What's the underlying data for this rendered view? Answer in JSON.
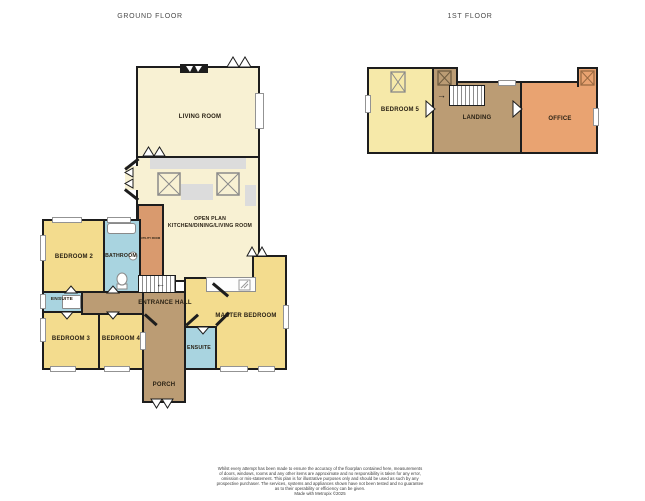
{
  "titles": {
    "ground": "GROUND FLOOR",
    "first": "1ST FLOOR"
  },
  "rooms": {
    "living_room": "LIVING ROOM",
    "open_plan_1": "OPEN PLAN",
    "open_plan_2": "KITCHEN/DINING/LIVING ROOM",
    "utility": "UTILITY ROOM",
    "bedroom2": "BEDROOM 2",
    "bathroom": "BATHROOM",
    "ensuite_left": "ENSUITE",
    "bedroom3": "BEDROOM 3",
    "bedroom4": "BEDROOM 4",
    "entrance_hall": "ENTRANCE HALL",
    "master_bedroom": "MASTER BEDROOM",
    "ensuite_master": "ENSUITE",
    "porch": "PORCH",
    "bedroom5": "BEDROOM 5",
    "landing": "LANDING",
    "office": "OFFICE"
  },
  "icons": {
    "stairs_down_arrow": "←",
    "stairs_up_arrow": "→"
  },
  "colors": {
    "wall": "#1d1d1d",
    "cream": "#f8f1d3",
    "bedroom_yellow": "#f3dc8e",
    "bedroom5_yellow": "#f6e9a9",
    "bath_blue": "#a9d4e0",
    "hall_tan": "#bb9c74",
    "utility_tan": "#d99a6e",
    "office_orange": "#e9a371",
    "counter_grey": "#dcdcdc"
  },
  "disclaimer": {
    "line1": "Whilst every attempt has been made to ensure the accuracy of the floorplan contained here, measurements",
    "line2": "of doors, windows, rooms and any other items are approximate and no responsibility is taken for any error,",
    "line3": "omission or mis-statement. This plan is for illustrative purposes only and should be used as such by any",
    "line4": "prospective purchaser. The services, systems and appliances shown have not been tested and no guarantee",
    "line5": "as to their operability or efficiency can be given.",
    "line6": "Made with Metropix ©2025"
  }
}
